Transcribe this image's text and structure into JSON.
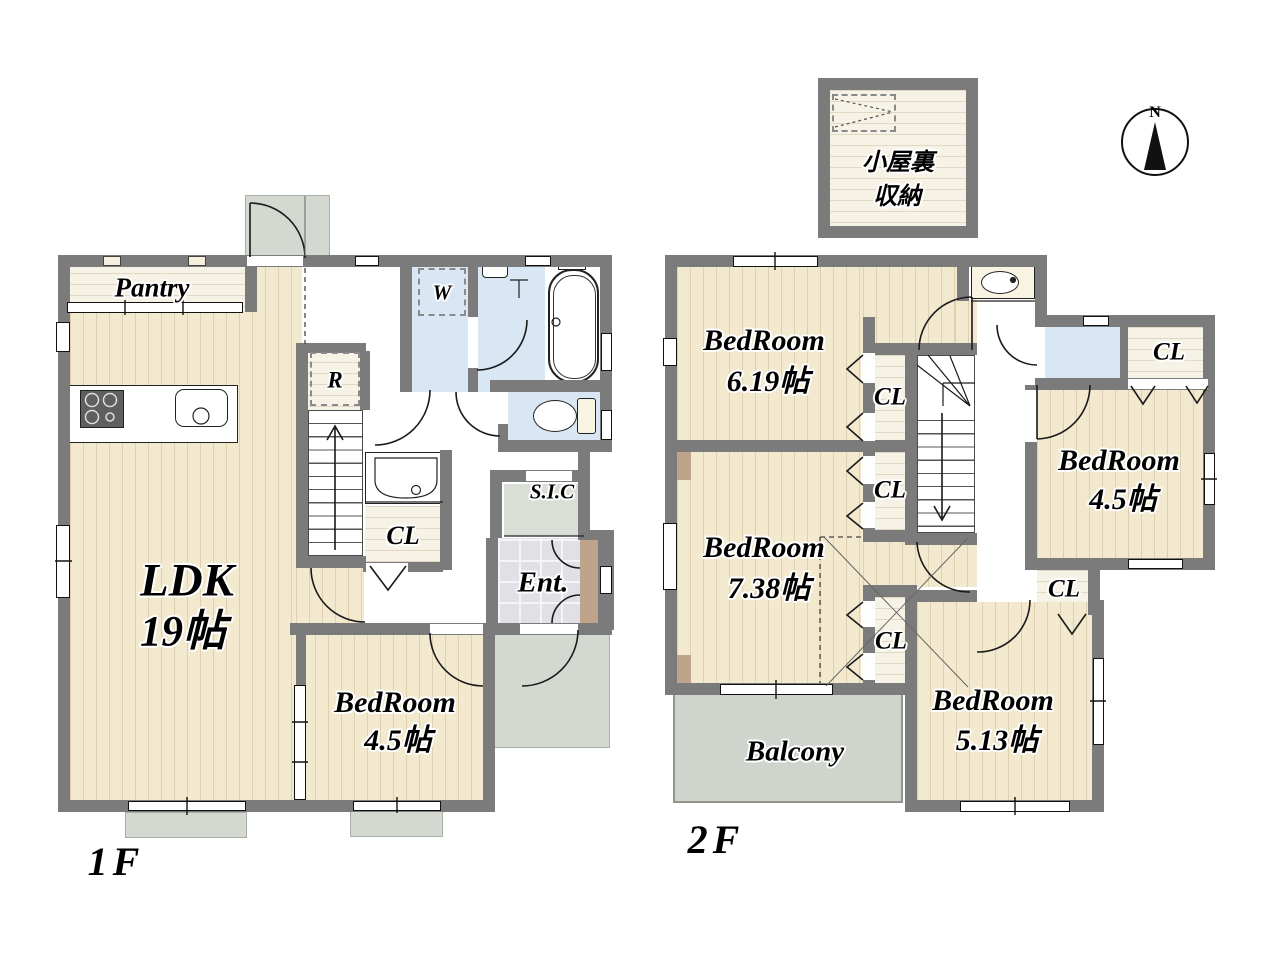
{
  "floor1": {
    "label": "1F",
    "pantry": "Pantry",
    "ldk": {
      "name": "LDK",
      "size": "19帖"
    },
    "bedroom": {
      "name": "BedRoom",
      "size": "4.5帖"
    },
    "closet": "CL",
    "shoe_closet": "S.I.C",
    "entrance": "Ent.",
    "washer": "W",
    "refrigerator": "R"
  },
  "floor2": {
    "label": "2F",
    "bedroom_619": {
      "name": "BedRoom",
      "size": "6.19帖"
    },
    "bedroom_738": {
      "name": "BedRoom",
      "size": "7.38帖"
    },
    "bedroom_45": {
      "name": "BedRoom",
      "size": "4.5帖"
    },
    "bedroom_513": {
      "name": "BedRoom",
      "size": "5.13帖"
    },
    "closet_1": "CL",
    "closet_2": "CL",
    "closet_3": "CL",
    "closet_4": "CL",
    "closet_5": "CL",
    "balcony": "Balcony",
    "attic": {
      "line1": "小屋裏",
      "line2": "収納"
    }
  },
  "compass": {
    "north": "N"
  },
  "colors": {
    "wall": "#7b7b7b",
    "wood_floor": "#f3e9cf",
    "light_floor": "#f7f2e6",
    "water_blue": "#d8e7f3",
    "porch_gray": "#d3d8d0",
    "balcony_gray": "#cfd5cc",
    "entrance_tile": "#e0e0e6",
    "cabinet_tan": "#bfa38a"
  }
}
